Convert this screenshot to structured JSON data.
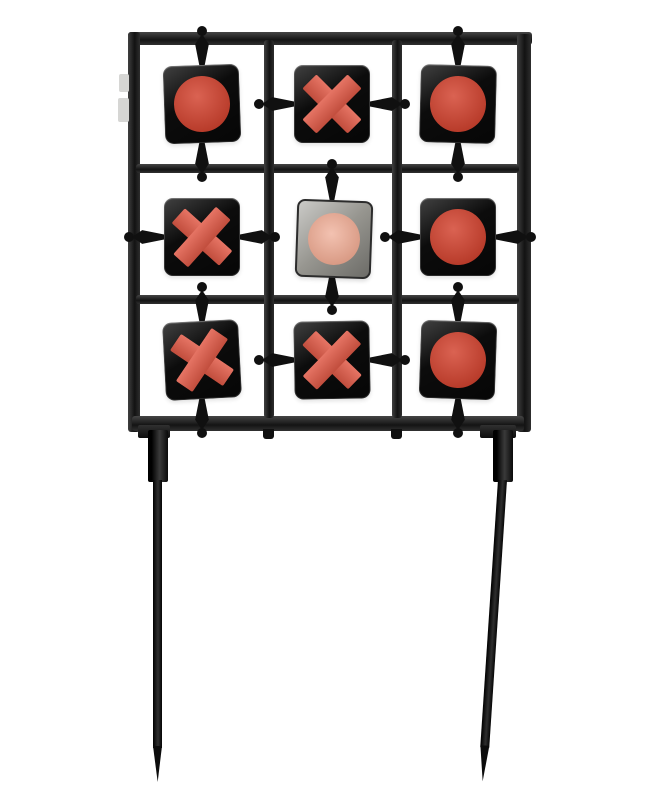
{
  "scene": {
    "description": "Product photo of a black steel tic-tac-toe spinner shooting target: 3x3 grid of square spinner plates in a frame with two pointed ground stakes",
    "background_color": "#ffffff"
  },
  "colors": {
    "background": "#ffffff",
    "frame": "#1d1d1d",
    "hardware": "#101010",
    "plate_front": "#0c0c0c",
    "plate_back": "#96958f",
    "circle_red": "#d2402c",
    "x_red": "#e15a47",
    "back_pink": "#eda58c",
    "clip_gray": "#d6d6d4"
  },
  "grid": {
    "rows": 3,
    "cols": 3,
    "pattern": [
      [
        "O",
        "X",
        "O"
      ],
      [
        "X",
        "O",
        "O"
      ],
      [
        "X",
        "X",
        "O"
      ]
    ],
    "cells": [
      {
        "row": 1,
        "col": 1,
        "symbol": "O",
        "face": "front",
        "mount": "vertical",
        "tilt_deg": -2,
        "symbol_tilt_deg": 0
      },
      {
        "row": 1,
        "col": 2,
        "symbol": "X",
        "face": "front",
        "mount": "horizontal",
        "tilt_deg": 0,
        "symbol_tilt_deg": 0
      },
      {
        "row": 1,
        "col": 3,
        "symbol": "O",
        "face": "front",
        "mount": "vertical",
        "tilt_deg": 1.5,
        "symbol_tilt_deg": 0
      },
      {
        "row": 2,
        "col": 1,
        "symbol": "X",
        "face": "front",
        "mount": "horizontal",
        "tilt_deg": 0,
        "symbol_tilt_deg": -3
      },
      {
        "row": 2,
        "col": 2,
        "symbol": "O",
        "face": "back",
        "mount": "vertical",
        "tilt_deg": 2,
        "symbol_tilt_deg": 0
      },
      {
        "row": 2,
        "col": 3,
        "symbol": "O",
        "face": "front",
        "mount": "horizontal",
        "tilt_deg": 0,
        "symbol_tilt_deg": 0
      },
      {
        "row": 3,
        "col": 1,
        "symbol": "X",
        "face": "front",
        "mount": "vertical",
        "tilt_deg": -3,
        "symbol_tilt_deg": -8
      },
      {
        "row": 3,
        "col": 2,
        "symbol": "X",
        "face": "front",
        "mount": "horizontal",
        "tilt_deg": -1,
        "symbol_tilt_deg": 0
      },
      {
        "row": 3,
        "col": 3,
        "symbol": "O",
        "face": "front",
        "mount": "vertical",
        "tilt_deg": 2,
        "symbol_tilt_deg": 0
      }
    ]
  },
  "stakes": {
    "count": 2,
    "style": "pointed ground spikes"
  }
}
